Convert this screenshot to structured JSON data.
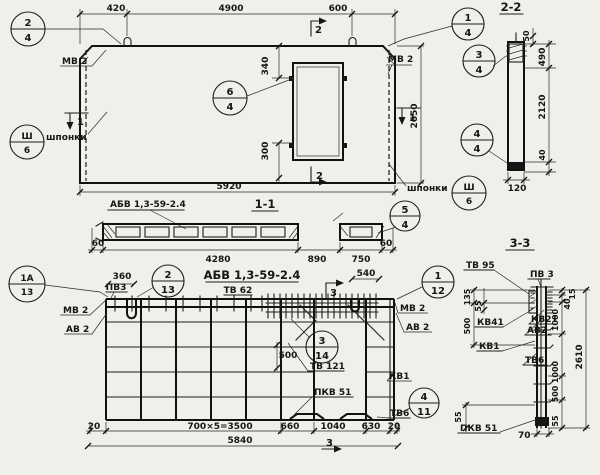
{
  "plan": {
    "d420": "420",
    "d4900": "4900",
    "d600": "600",
    "d5920": "5920",
    "d2650": "2650",
    "d340": "340",
    "d300": "300",
    "mv2a": "МВ 2",
    "mv2b": "МВ 2",
    "shponki_l": "шпонки",
    "shponki_r": "шпонки",
    "s2t": "2",
    "s2b": "2",
    "s1l": "1",
    "s1r": "1",
    "circles": {
      "c24": [
        "2",
        "4"
      ],
      "c14": [
        "1",
        "4"
      ],
      "c64": [
        "6",
        "4"
      ],
      "c54": [
        "5",
        "4"
      ],
      "sh_l": [
        "Ш",
        "6"
      ],
      "sh_r": [
        "Ш",
        "6"
      ]
    }
  },
  "sec22": {
    "title": "2-2",
    "d50": "50",
    "d490": "490",
    "d2120": "2120",
    "d40": "40",
    "d120": "120",
    "circles": {
      "c34": [
        "3",
        "4"
      ],
      "c44": [
        "4",
        "4"
      ]
    }
  },
  "sec11": {
    "title": "1-1",
    "label": "АБВ 1,3-59-2.4",
    "d60l": "60",
    "d4280": "4280",
    "d890": "890",
    "d750": "750",
    "d60r": "60"
  },
  "rplan": {
    "title": "АБВ 1,3-59-2.4",
    "tv62": "ТВ 62",
    "d360": "360",
    "pv3": "ПВ3",
    "mv2l": "МВ 2",
    "av2l": "АВ 2",
    "mv2r": "МВ 2",
    "av2r": "АВ 2",
    "d540": "540",
    "s3t": "3",
    "s3b": "3",
    "d500": "500",
    "tv121": "ТВ 121",
    "kv1": "КВ1",
    "pkv51": "ПКВ 51",
    "tv6": "ТВ6",
    "d20l": "20",
    "d3500": "700×5=3500",
    "d660": "660",
    "d1040": "1040",
    "d630": "630",
    "d20r": "20",
    "d5840": "5840",
    "circles": {
      "c1a13": [
        "1А",
        "13"
      ],
      "c213": [
        "2",
        "13"
      ],
      "c112": [
        "1",
        "12"
      ],
      "c314": [
        "3",
        "14"
      ],
      "c411": [
        "4",
        "11"
      ]
    }
  },
  "sec33": {
    "title": "3-3",
    "tv95": "ТВ 95",
    "pv3": "ПВ 3",
    "kv41": "КВ41",
    "kv21": "КВ21",
    "av2": "АВ2",
    "kv1": "КВ1",
    "tv6": "ТВ6",
    "pkv51": "ПКВ 51",
    "d135": "135",
    "d55a": "55",
    "d500l": "500",
    "d15": "15",
    "d40": "40",
    "d1000a": "1000",
    "d1000b": "1000",
    "d500r": "500",
    "d55b": "55",
    "d2610": "2610",
    "d55c": "55",
    "d70": "70"
  }
}
